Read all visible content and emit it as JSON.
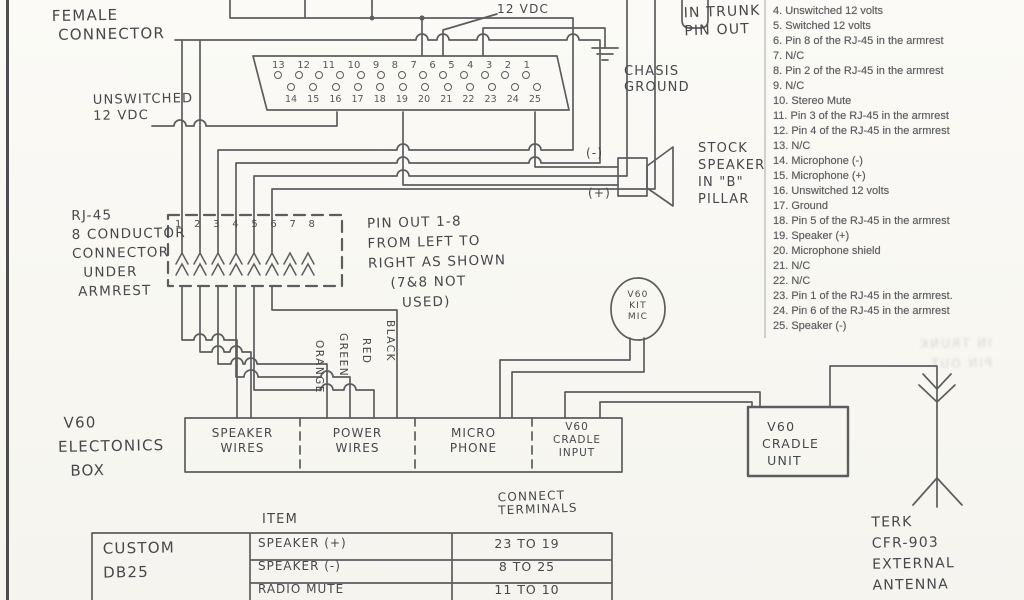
{
  "diagram": {
    "ink_color": "#4c4d50",
    "labels": {
      "female_connector": "FEMALE\n CONNECTOR",
      "unswitched_12vdc": "UNSWITCHED\n12 VDC",
      "switched_12vdc": "SWITCHED\n12 VDC",
      "chasis_ground": "CHASIS\nGROUND",
      "in_trunk_pinout": "IN TRUNK\nPIN OUT",
      "rj45_connector": "RJ-45\n8 CONDUCTOR\nCONNECTOR\n  UNDER\n ARMREST",
      "pinout_note": "PIN OUT 1-8\nFROM LEFT TO\nRIGHT AS SHOWN\n    (7&8 NOT\n      USED)",
      "stock_speaker": "STOCK\nSPEAKER\nIN \"B\"\nPILLAR",
      "speaker_minus": "(-)",
      "speaker_plus": "(+)",
      "mic": "V60\nKIT\nMIC",
      "v60_electronics_box": " V60\nELECTONICS\n  BOX",
      "cradle_unit": " V60\nCRADLE\n UNIT",
      "terk_antenna": "TERK\nCFR-903\nEXTERNAL\nANTENNA",
      "item_header": "ITEM",
      "connect_terminals_header": "CONNECT\nTERMINALS",
      "custom_db25": "CUSTOM\nDB25",
      "ghost_text": "IN TRUNK\nPIN OUT"
    },
    "db25": {
      "top_pins": [
        13,
        12,
        11,
        10,
        9,
        8,
        7,
        6,
        5,
        4,
        3,
        2,
        1
      ],
      "bottom_pins": [
        14,
        15,
        16,
        17,
        18,
        19,
        20,
        21,
        22,
        23,
        24,
        25
      ]
    },
    "rj45": {
      "pins": [
        1,
        2,
        3,
        4,
        5,
        6,
        7,
        8
      ]
    },
    "wire_colors": [
      "ORANGE",
      "GREEN",
      "RED",
      "BLACK"
    ],
    "component_boxes": [
      "SPEAKER\nWIRES",
      "POWER\nWIRES",
      "MICRO\nPHONE",
      "V60\nCRADLE\nINPUT"
    ],
    "trunk_pinout": {
      "items": [
        "4. Unswitched 12 volts",
        "5. Switched 12 volts",
        "6. Pin 8 of the RJ-45 in the armrest",
        "7. N/C",
        "8. Pin 2 of the RJ-45 in the armrest",
        "9. N/C",
        "10. Stereo Mute",
        "11. Pin 3 of the RJ-45 in the armrest",
        "12. Pin 4 of the RJ-45 in the armrest",
        "13. N/C",
        "14. Microphone (-)",
        "15. Microphone (+)",
        "16. Unswitched 12 volts",
        "17. Ground",
        "18. Pin 5 of the RJ-45 in the armrest",
        "19. Speaker (+)",
        "20. Microphone shield",
        "21. N/C",
        "22. N/C",
        "23. Pin 1 of the RJ-45 in the armrest.",
        "24. Pin 6 of the RJ-45 in the armrest",
        "25. Speaker (-)"
      ]
    },
    "connection_table": {
      "rows": [
        {
          "item": "SPEAKER (+)",
          "terminals": "23 TO 19"
        },
        {
          "item": "SPEAKER (-)",
          "terminals": "8 TO 25"
        },
        {
          "item": "RADIO MUTE",
          "terminals": "11 TO 10"
        }
      ]
    }
  }
}
